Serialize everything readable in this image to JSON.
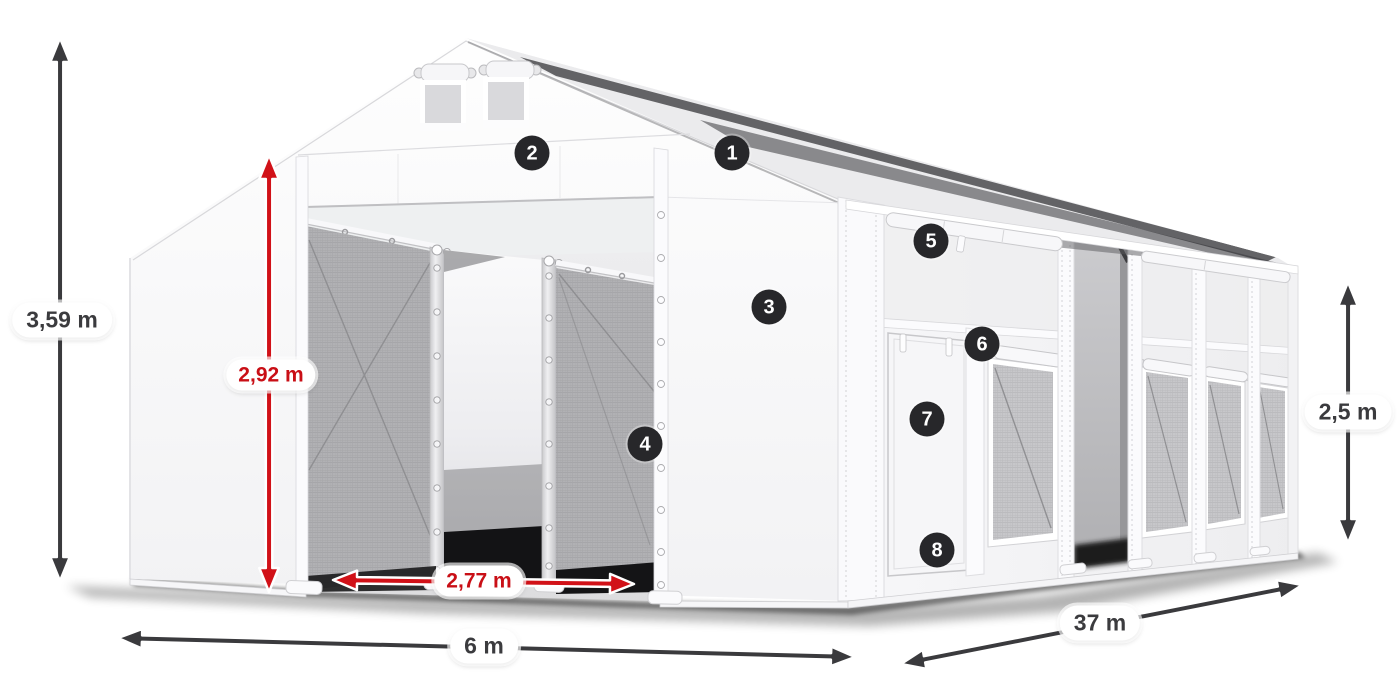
{
  "figure": {
    "title": "Storage tent with numbered features and dimension callouts",
    "background": "#ffffff"
  },
  "colors": {
    "arrow_dark": "#3a3a3d",
    "arrow_red": "#d11118",
    "label_dark": "#3b3b3e",
    "label_red": "#c90f16",
    "pill_bg": "#ffffff",
    "badge_bg": "#27272a",
    "badge_text": "#ffffff"
  },
  "dimensions": {
    "total_height": {
      "label": "3,59 m"
    },
    "entrance_height": {
      "label": "2,92 m"
    },
    "entrance_width": {
      "label": "2,77 m"
    },
    "width": {
      "label": "6 m"
    },
    "length": {
      "label": "37 m"
    },
    "side_height": {
      "label": "2,5 m"
    }
  },
  "callouts": [
    {
      "number": "1"
    },
    {
      "number": "2"
    },
    {
      "number": "3"
    },
    {
      "number": "4"
    },
    {
      "number": "5"
    },
    {
      "number": "6"
    },
    {
      "number": "7"
    },
    {
      "number": "8"
    }
  ]
}
